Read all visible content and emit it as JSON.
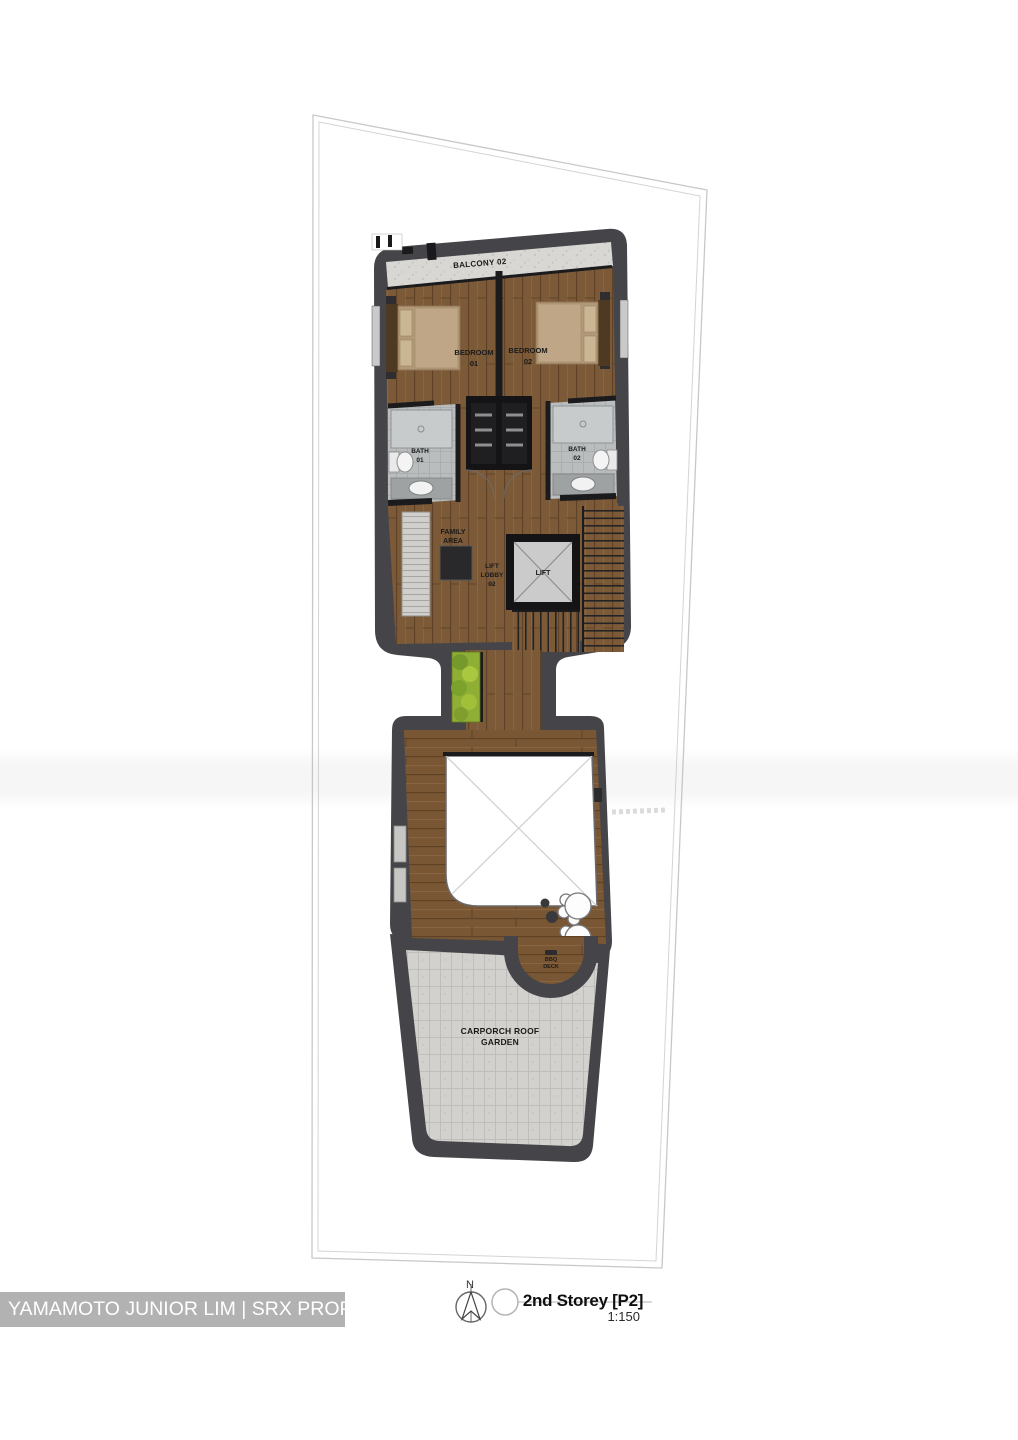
{
  "plan": {
    "labels": {
      "balcony": "BALCONY 02",
      "bedroom1": [
        "BEDROOM",
        "01"
      ],
      "bedroom2": [
        "BEDROOM",
        "02"
      ],
      "bath1": [
        "BATH",
        "01"
      ],
      "bath2": [
        "BATH",
        "02"
      ],
      "family_area": [
        "FAMILY",
        "AREA"
      ],
      "lift_lobby": [
        "LIFT",
        "LOBBY",
        "02"
      ],
      "lift": "LIFT",
      "bbq_deck": [
        "BBQ",
        "DECK"
      ],
      "carporch": [
        "CARPORCH ROOF",
        "GARDEN"
      ]
    },
    "colors": {
      "wall_band": "#454549",
      "wood_floor": "#7c5a38",
      "balcony_concrete": "#d8d7d3",
      "bath_tile": "#babdbe",
      "paver_gray": "#d2d1cd",
      "planter_green": "#8fae35",
      "void_white": "#ffffff"
    }
  },
  "legend": {
    "north_label": "N",
    "title": "2nd Storey [P2]",
    "scale": "1:150"
  },
  "watermark": {
    "text": "YAMAMOTO JUNIOR LIM | SRX PROPERTY",
    "bar_color": "#b2b2b2"
  }
}
